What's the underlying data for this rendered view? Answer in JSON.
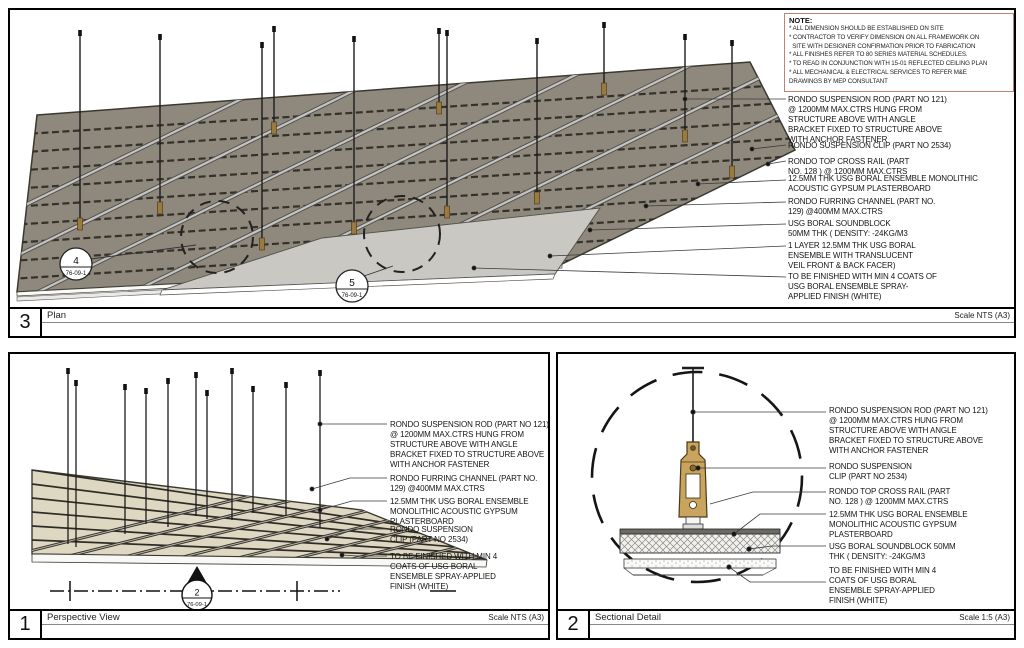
{
  "sheet": {
    "bg": "#ffffff"
  },
  "colors": {
    "note_border": "#c08272",
    "plan_plane": "#8f897d",
    "perspective_plane": "#ded8c2",
    "clip_tan": "#c9a45f",
    "board_gray": "#cac8c3"
  },
  "note": {
    "title": "NOTE:",
    "body": "* ALL DIMENSION SHOULD BE ESTABLISHED ON SITE\n* CONTRACTOR TO VERIFY DIMENSION ON ALL FRAMEWORK ON\n  SITE WITH DESIGNER CONFIRMATION PRIOR TO FABRICATION\n* ALL FINISHES REFER TO 80 SERIES MATERIAL SCHEDULES.\n* TO READ IN CONJUNCTION WITH 15-01 REFLECTED CEILING PLAN\n* ALL MECHANICAL & ELECTRICAL SERVICES TO REFER M&E\nDRAWINGS BY MEP CONSULTANT"
  },
  "panels": {
    "plan": {
      "number": "3",
      "title": "Plan",
      "scale": "Scale NTS (A3)",
      "callouts": [
        {
          "num": "4",
          "ref": "76-09-1"
        },
        {
          "num": "5",
          "ref": "76-09-1"
        }
      ],
      "labels": [
        "RONDO SUSPENSION ROD (PART NO 121)\n@ 1200MM MAX.CTRS HUNG FROM\nSTRUCTURE ABOVE WITH ANGLE\nBRACKET FIXED TO STRUCTURE ABOVE\nWITH ANCHOR FASTENER",
        "RONDO SUSPENSION CLIP (PART NO 2534)",
        "RONDO TOP CROSS RAIL (PART\nNO. 128 ) @ 1200MM MAX.CTRS",
        "12.5MM THK USG BORAL ENSEMBLE MONOLITHIC\nACOUSTIC GYPSUM PLASTERBOARD",
        "RONDO FURRING CHANNEL (PART NO.\n129) @400MM MAX.CTRS",
        "USG BORAL SOUNDBLOCK\n50MM THK ( DENSITY: -24KG/M3",
        "1 LAYER 12.5MM THK USG BORAL\nENSEMBLE WITH TRANSLUCENT\nVEIL FRONT & BACK FACER)",
        "TO BE FINISHED WITH MIN 4 COATS OF\nUSG BORAL ENSEMBLE SPRAY-\nAPPLIED FINISH (WHITE)"
      ]
    },
    "perspective": {
      "number": "1",
      "title": "Perspective View",
      "scale": "Scale NTS (A3)",
      "marker": {
        "num": "2",
        "ref": "76-09-1"
      },
      "labels": [
        "RONDO SUSPENSION ROD (PART NO 121)\n@ 1200MM MAX.CTRS HUNG FROM\nSTRUCTURE ABOVE WITH ANGLE\nBRACKET FIXED TO STRUCTURE ABOVE\nWITH ANCHOR FASTENER",
        "RONDO FURRING CHANNEL (PART NO.\n129) @400MM MAX.CTRS",
        "12.5MM THK USG BORAL ENSEMBLE\nMONOLITHIC ACOUSTIC GYPSUM\nPLASTERBOARD",
        "RONDO SUSPENSION\nCLIP (PART NO 2534)",
        "TO BE FINISHED WITH MIN 4\nCOATS OF USG BORAL\nENSEMBLE SPRAY-APPLIED\nFINISH (WHITE)"
      ]
    },
    "sectional": {
      "number": "2",
      "title": "Sectional Detail",
      "scale": "Scale 1:5 (A3)",
      "labels": [
        "RONDO SUSPENSION ROD (PART NO 121)\n@ 1200MM MAX.CTRS HUNG FROM\nSTRUCTURE ABOVE WITH ANGLE\nBRACKET FIXED TO STRUCTURE ABOVE\nWITH ANCHOR FASTENER",
        "RONDO SUSPENSION\nCLIP (PART NO 2534)",
        "RONDO TOP CROSS RAIL (PART\nNO. 128 ) @ 1200MM MAX.CTRS",
        "12.5MM THK USG BORAL ENSEMBLE\nMONOLITHIC ACOUSTIC GYPSUM\nPLASTERBOARD",
        "USG BORAL SOUNDBLOCK 50MM\nTHK ( DENSITY: -24KG/M3",
        "TO BE FINISHED WITH MIN 4\nCOATS OF USG BORAL\nENSEMBLE SPRAY-APPLIED\nFINISH (WHITE)"
      ]
    }
  }
}
